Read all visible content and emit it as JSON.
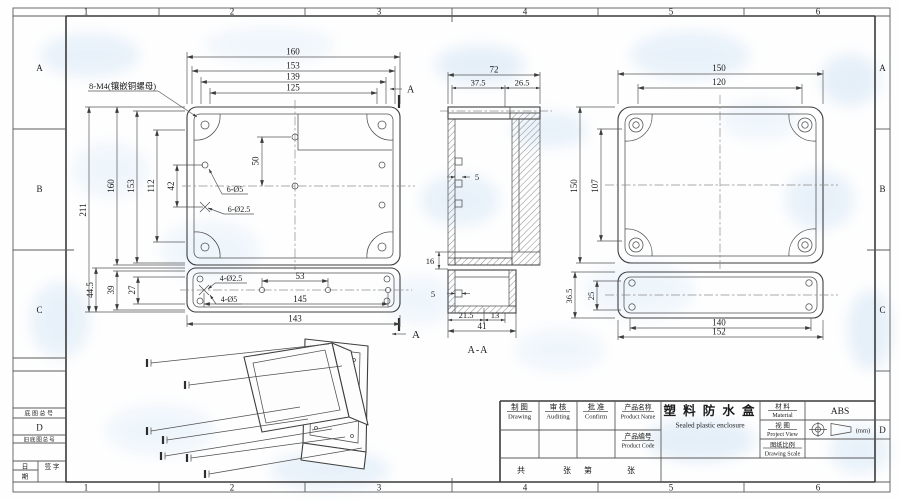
{
  "frame": {
    "top_zones": [
      "1",
      "2",
      "3",
      "4",
      "5",
      "6"
    ],
    "bottom_zones": [
      "1",
      "2",
      "3",
      "4",
      "5",
      "6"
    ],
    "left_zones": [
      "A",
      "B",
      "C",
      "D"
    ],
    "right_zones": [
      "A",
      "B",
      "C",
      "D"
    ]
  },
  "left_panel": {
    "base_drawing_no": "底图总号",
    "old_base_drawing_no": "旧底图总号",
    "date_top": "日",
    "date_bottom": "期",
    "signature": "签 字"
  },
  "title_block": {
    "drawing_cn": "制 图",
    "drawing_en": "Drawing",
    "auditing_cn": "审 核",
    "auditing_en": "Auditing",
    "confirm_cn": "批 准",
    "confirm_en": "Confirm",
    "product_name_label_cn": "产品名称",
    "product_name_label_en": "Product Name",
    "product_code_label_cn": "产品编号",
    "product_code_label_en": "Product Code",
    "product_name_cn": "塑 料 防 水 盒",
    "product_name_en": "Sealed plastic enclosure",
    "material_label_cn": "材 料",
    "material_label_en": "Material",
    "material_value": "ABS",
    "view_label_cn": "视 图",
    "view_label_en": "Project View",
    "scale_label_cn": "图纸比例",
    "scale_label_en": "Drawing Scale",
    "units": "(mm)",
    "sheet_total": "共",
    "sheet_total_unit": "张",
    "sheet_no": "第",
    "sheet_no_unit": "张"
  },
  "views": {
    "front": {
      "note": "8-M4(镶嵌铜螺母)",
      "d160t": "160",
      "d153t": "153",
      "d139": "139",
      "d125": "125",
      "d211": "211",
      "d160l": "160",
      "d153l": "153",
      "d112": "112",
      "d42": "42",
      "d50": "50",
      "holes_outer": "6-Ø5",
      "holes_inner": "6-Ø2.5",
      "sec_a_top": "A",
      "sec_a_bottom": "A"
    },
    "cover": {
      "d445": "44.5",
      "d39": "39",
      "d27": "27",
      "holes_inner": "4-Ø2.5",
      "holes_outer": "4-Ø5",
      "d53": "53",
      "d145": "145",
      "d143": "143"
    },
    "section": {
      "d72": "72",
      "d375": "37.5",
      "d265": "26.5",
      "d5a": "5",
      "d16": "16",
      "d5b": "5",
      "d215": "21.5",
      "d13": "13",
      "d41": "41",
      "label": "A-A"
    },
    "side": {
      "d150t": "150",
      "d120": "120",
      "d150l": "150",
      "d107": "107",
      "d365": "36.5",
      "d25": "25",
      "d140": "140",
      "d152": "152"
    }
  }
}
